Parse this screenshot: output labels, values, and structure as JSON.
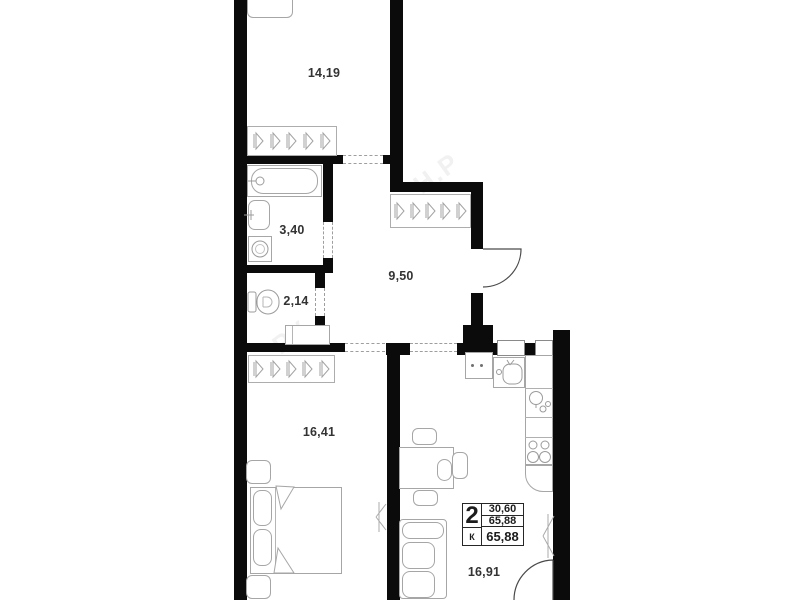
{
  "plan": {
    "rooms": [
      {
        "name": "room-top",
        "area_label": "14,19"
      },
      {
        "name": "bathroom",
        "area_label": "3,40"
      },
      {
        "name": "toilet",
        "area_label": "2,14"
      },
      {
        "name": "hallway",
        "area_label": "9,50"
      },
      {
        "name": "bedroom",
        "area_label": "16,41"
      },
      {
        "name": "kitchen-living",
        "area_label": "16,91"
      }
    ],
    "info_box": {
      "rooms_count": "2",
      "rooms_letter": "К",
      "row1": "30,60",
      "row2": "65,88",
      "row3": "65,88"
    },
    "colors": {
      "wall": "#0b0b0b",
      "furniture_line": "#a6a6a6",
      "label_text": "#333333"
    },
    "watermark_fragments": [
      "Н.Р",
      "РУ"
    ]
  }
}
